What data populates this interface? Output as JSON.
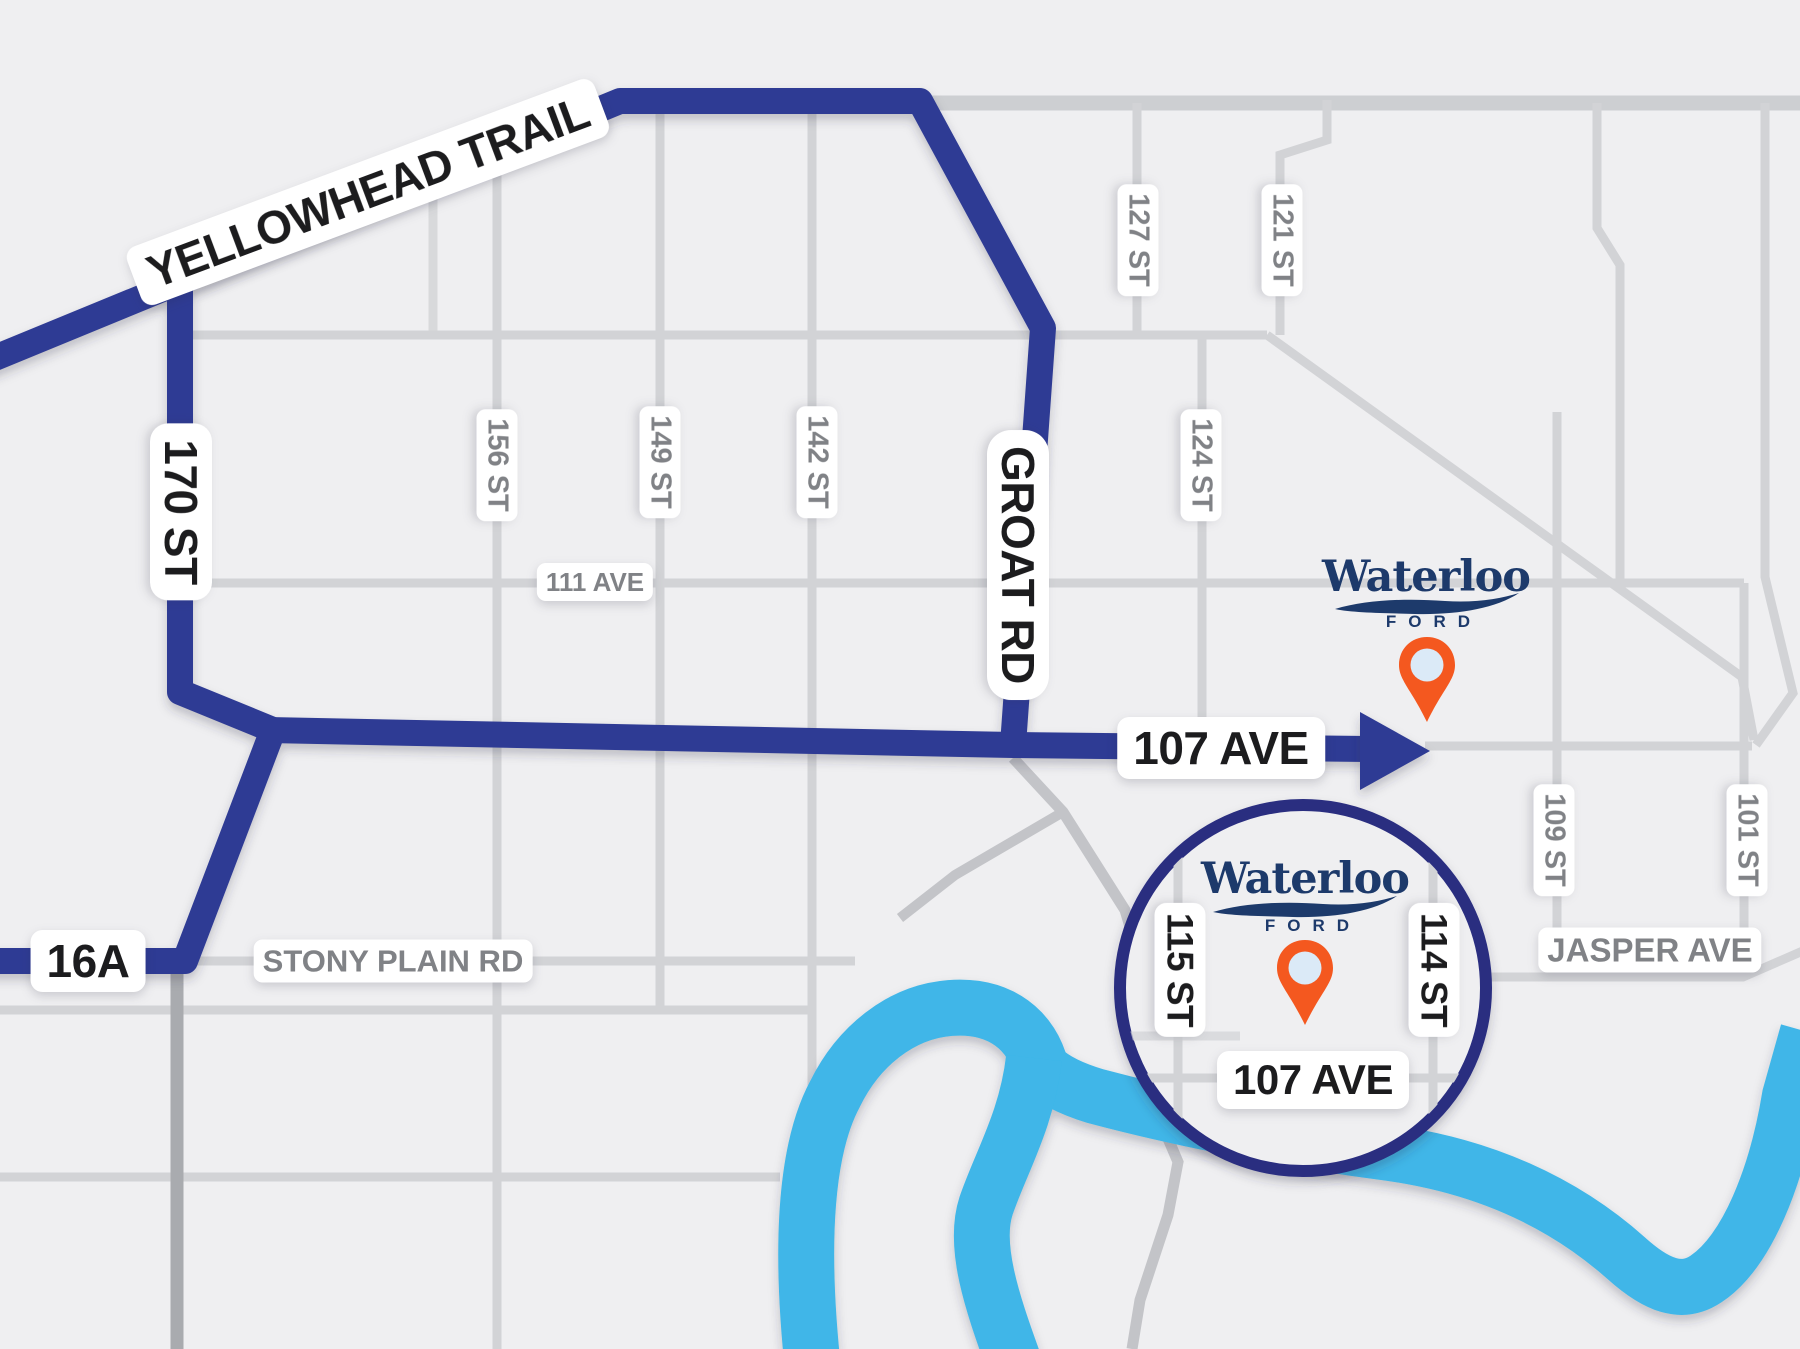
{
  "title": "Waterloo Ford location map",
  "colors": {
    "background": "#efeff1",
    "route_blue": "#2f3b94",
    "river_cyan": "#3fb6e8",
    "road_gray": "#d2d3d6",
    "road_gray_dark": "#a9abaf",
    "ring_navy": "#2a2d80",
    "label_black": "#1c1c1e",
    "label_gray": "#808286",
    "brand_navy": "#1d3a6b",
    "pin_orange": "#f4581f",
    "pin_hole_blue": "#dbeaf7"
  },
  "routes": {
    "yellowhead": "YELLOWHEAD TRAIL",
    "st_170": "170 ST",
    "groat_rd": "GROAT RD",
    "ave_107": "107 AVE",
    "hwy_16a": "16A"
  },
  "streets": {
    "stony_plain": "STONY PLAIN RD",
    "ave_111": "111 AVE",
    "jasper_ave": "JASPER AVE",
    "st_156": "156 ST",
    "st_149": "149 ST",
    "st_142": "142 ST",
    "st_127": "127 ST",
    "st_121": "121 ST",
    "st_124": "124 ST",
    "st_109": "109 ST",
    "st_101": "101 ST"
  },
  "inset": {
    "st_115": "115 ST",
    "st_114": "114 ST",
    "ave_107": "107 AVE"
  },
  "brand": {
    "name": "Waterloo",
    "division": "FORD"
  }
}
